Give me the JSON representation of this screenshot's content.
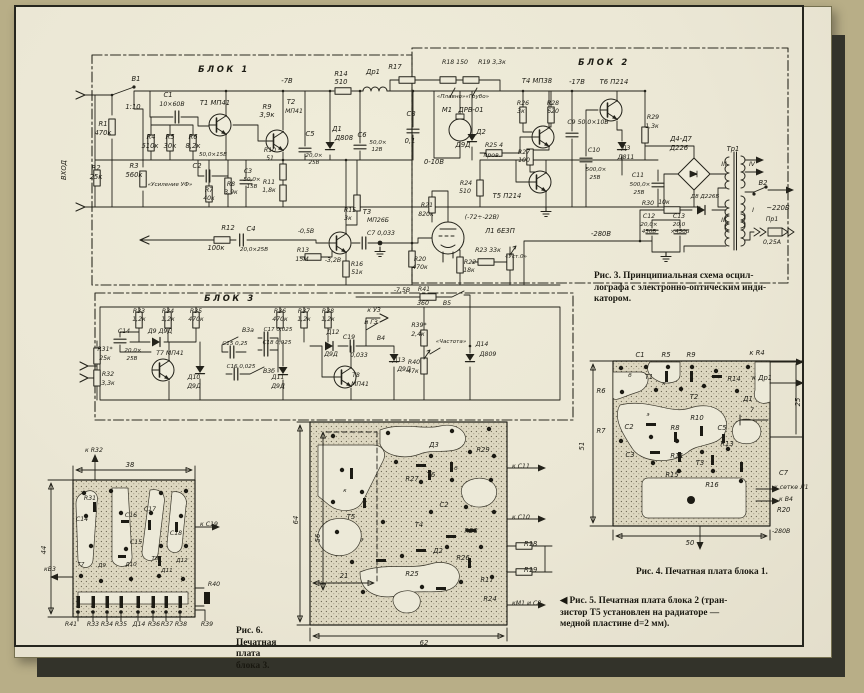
{
  "captions": {
    "fig3": [
      "Рис. 3. Принципиальная схема осцил-",
      "лографа с электронно-оптическим инди-",
      "катором."
    ],
    "fig4": [
      "Рис. 4. Печатная плата блока 1."
    ],
    "fig5": [
      "◀ Рис. 5. Печатная плата блока 2 (тран-",
      "зистор Т5 установлен на радиаторе —",
      "медной пластине d=2 мм)."
    ],
    "fig6": [
      "Рис. 6.",
      "Печатная",
      "плата",
      "блока 3."
    ]
  },
  "labels": {
    "schematic": [
      [
        "БЛОК 1",
        224,
        72,
        "b"
      ],
      [
        "БЛОК 2",
        604,
        65,
        "b"
      ],
      [
        "БЛОК 3",
        230,
        301,
        "b"
      ],
      [
        "ВХОД",
        66,
        170,
        "r"
      ],
      [
        "В1",
        136,
        81
      ],
      [
        "1:10",
        133,
        109
      ],
      [
        "C1",
        168,
        97
      ],
      [
        "10×60В",
        172,
        106,
        "m"
      ],
      [
        "R1",
        103,
        126
      ],
      [
        "470к",
        103,
        135
      ],
      [
        "R2",
        96,
        170
      ],
      [
        "25к",
        96,
        179
      ],
      [
        "R3",
        134,
        168
      ],
      [
        "560к",
        134,
        177
      ],
      [
        "«Усиление УФ»",
        170,
        186,
        "s"
      ],
      [
        "R4",
        151,
        139
      ],
      [
        "510к",
        150,
        148
      ],
      [
        "R5",
        170,
        139
      ],
      [
        "30к",
        170,
        148
      ],
      [
        "R6",
        193,
        139
      ],
      [
        "8,2к",
        193,
        148
      ],
      [
        "Т1 МП41",
        215,
        105
      ],
      [
        "C2",
        197,
        168
      ],
      [
        "50,0×15В",
        213,
        156,
        "s"
      ],
      [
        "R7",
        209,
        192,
        "m"
      ],
      [
        "40к",
        209,
        200,
        "m"
      ],
      [
        "R8",
        231,
        186,
        "m"
      ],
      [
        "3,9к",
        231,
        194,
        "m"
      ],
      [
        "C3",
        248,
        173,
        "m"
      ],
      [
        "50,0×",
        252,
        181,
        "s"
      ],
      [
        "15В",
        252,
        188,
        "s"
      ],
      [
        "-7В",
        287,
        83
      ],
      [
        "R9",
        267,
        109
      ],
      [
        "3,9к",
        267,
        117
      ],
      [
        "Т2",
        291,
        104
      ],
      [
        "МП41",
        294,
        113,
        "m"
      ],
      [
        "C5",
        310,
        136
      ],
      [
        "20,0×",
        314,
        157,
        "s"
      ],
      [
        "25В",
        314,
        164,
        "s"
      ],
      [
        "R10",
        270,
        152,
        "m"
      ],
      [
        "51",
        270,
        160,
        "m"
      ],
      [
        "R11",
        269,
        184,
        "m"
      ],
      [
        "1,8к",
        269,
        192,
        "m"
      ],
      [
        "R14",
        341,
        76
      ],
      [
        "510",
        341,
        84
      ],
      [
        "Др1",
        373,
        74
      ],
      [
        "Д1",
        337,
        131
      ],
      [
        "Д808",
        344,
        140
      ],
      [
        "C6",
        362,
        137
      ],
      [
        "50,0×",
        378,
        144,
        "s"
      ],
      [
        "12В",
        377,
        151,
        "s"
      ],
      [
        "C8",
        411,
        116
      ],
      [
        "0,1",
        410,
        143
      ],
      [
        "R17",
        395,
        69
      ],
      [
        "R18 150",
        455,
        64,
        "m"
      ],
      [
        "R19 3,3к",
        492,
        64,
        "m"
      ],
      [
        "«Плавно»«Грубо»",
        463,
        98,
        "s"
      ],
      [
        "Т4 МП38",
        537,
        83
      ],
      [
        "-17В",
        577,
        84
      ],
      [
        "М1",
        447,
        112
      ],
      [
        "ДРВ-01",
        471,
        112
      ],
      [
        "Д2",
        481,
        134
      ],
      [
        "Д9Д",
        463,
        147
      ],
      [
        "0-10В",
        434,
        164
      ],
      [
        "R26",
        523,
        105,
        "m"
      ],
      [
        "3к",
        521,
        113,
        "m"
      ],
      [
        "R28",
        553,
        105,
        "m"
      ],
      [
        "620",
        553,
        113,
        "m"
      ],
      [
        "R27",
        524,
        154,
        "m"
      ],
      [
        "100",
        524,
        162,
        "m"
      ],
      [
        "R25 4",
        494,
        147,
        "m"
      ],
      [
        "пров.",
        492,
        157,
        "m"
      ],
      [
        "R24",
        466,
        185,
        "m"
      ],
      [
        "510",
        465,
        193,
        "m"
      ],
      [
        "Т5 П214",
        507,
        198
      ],
      [
        "C9 50,0×10В",
        588,
        124,
        "m"
      ],
      [
        "Т6 П214",
        614,
        84
      ],
      [
        "C10",
        594,
        152,
        "m"
      ],
      [
        "500,0×",
        596,
        171,
        "s"
      ],
      [
        "25В",
        595,
        179,
        "s"
      ],
      [
        "Д3",
        626,
        150,
        "m"
      ],
      [
        "Д811",
        626,
        159,
        "m"
      ],
      [
        "R29",
        653,
        119,
        "m"
      ],
      [
        "1,3к",
        652,
        128,
        "m"
      ],
      [
        "C11",
        638,
        177,
        "m"
      ],
      [
        "500,0×",
        640,
        186,
        "s"
      ],
      [
        "25В",
        639,
        194,
        "s"
      ],
      [
        "Д4-Д7",
        681,
        141
      ],
      [
        "Д226",
        679,
        150
      ],
      [
        "Тр1",
        733,
        151
      ],
      [
        "R30",
        648,
        205,
        "m"
      ],
      [
        "10к",
        664,
        204,
        "m"
      ],
      [
        "Д8 Д226Б",
        705,
        198,
        "s"
      ],
      [
        "C12",
        649,
        218,
        "m"
      ],
      [
        "20,0×",
        649,
        226,
        "s"
      ],
      [
        "450В",
        649,
        233,
        "s"
      ],
      [
        "C13",
        679,
        218,
        "m"
      ],
      [
        "20,0",
        679,
        226,
        "s"
      ],
      [
        "×450В",
        680,
        233,
        "s"
      ],
      [
        "-280В",
        601,
        236
      ],
      [
        "III",
        724,
        166,
        "m"
      ],
      [
        "IV",
        752,
        166,
        "m"
      ],
      [
        "II",
        723,
        222,
        "m"
      ],
      [
        "I",
        753,
        212,
        "m"
      ],
      [
        "В2",
        763,
        185
      ],
      [
        "~220В",
        778,
        210
      ],
      [
        "Пр1",
        772,
        221,
        "m"
      ],
      [
        "0,25А",
        772,
        244,
        "m"
      ],
      [
        "R12",
        228,
        230
      ],
      [
        "100к",
        216,
        250
      ],
      [
        "C4",
        251,
        231
      ],
      [
        "20,0×25В",
        254,
        251,
        "s"
      ],
      [
        "Т3",
        367,
        214
      ],
      [
        "МП26Б",
        378,
        222,
        "m"
      ],
      [
        "R15",
        350,
        212,
        "m"
      ],
      [
        "3к",
        348,
        220,
        "m"
      ],
      [
        "-0,5В",
        306,
        233,
        "m"
      ],
      [
        "R13",
        303,
        252,
        "m"
      ],
      [
        "15М",
        302,
        261,
        "m"
      ],
      [
        "-3,2В",
        333,
        262,
        "m"
      ],
      [
        "R16",
        357,
        266,
        "m"
      ],
      [
        "51к",
        357,
        274,
        "m"
      ],
      [
        "C7 0,033",
        381,
        235,
        "m"
      ],
      [
        "R20",
        420,
        261,
        "m"
      ],
      [
        "470к",
        420,
        269,
        "m"
      ],
      [
        "R21",
        427,
        207,
        "m"
      ],
      [
        "820к",
        426,
        216,
        "m"
      ],
      [
        "(-72÷-22В)",
        482,
        219,
        "m"
      ],
      [
        "Л1 6Е3П",
        500,
        233
      ],
      [
        "R23 33к",
        488,
        252,
        "m"
      ],
      [
        "«Уст.0»",
        516,
        258,
        "s"
      ],
      [
        "R22",
        470,
        264,
        "m"
      ],
      [
        "18к",
        469,
        272,
        "m"
      ],
      [
        "-7,5В",
        402,
        292,
        "m"
      ],
      [
        "R41",
        424,
        291,
        "m"
      ],
      [
        "360",
        423,
        305,
        "m"
      ],
      [
        "В5",
        447,
        305,
        "m"
      ],
      [
        "R33",
        139,
        313,
        "m"
      ],
      [
        "1,2к",
        139,
        321,
        "m"
      ],
      [
        "R34",
        168,
        313,
        "m"
      ],
      [
        "1,2к",
        168,
        321,
        "m"
      ],
      [
        "R35",
        196,
        313,
        "m"
      ],
      [
        "470к",
        196,
        321,
        "m"
      ],
      [
        "R36",
        280,
        313,
        "m"
      ],
      [
        "470к",
        280,
        321,
        "m"
      ],
      [
        "R37",
        304,
        313,
        "m"
      ],
      [
        "1,2к",
        304,
        321,
        "m"
      ],
      [
        "R38",
        328,
        313,
        "m"
      ],
      [
        "1,2к",
        328,
        321,
        "m"
      ],
      [
        "C14",
        124,
        333,
        "m"
      ],
      [
        "20,0×",
        133,
        352,
        "s"
      ],
      [
        "25В",
        132,
        360,
        "s"
      ],
      [
        "R31*",
        105,
        351,
        "m"
      ],
      [
        "25к",
        105,
        360,
        "m"
      ],
      [
        "R32",
        108,
        376,
        "m"
      ],
      [
        "3,3к",
        108,
        385,
        "m"
      ],
      [
        "Д9 Д9Д",
        160,
        333,
        "m"
      ],
      [
        "Т7 МП41",
        170,
        355,
        "m"
      ],
      [
        "В3а",
        248,
        332,
        "m"
      ],
      [
        "C15 0,25",
        235,
        345,
        "s"
      ],
      [
        "C17 0,025",
        278,
        331,
        "s"
      ],
      [
        "C18 0,025",
        277,
        344,
        "s"
      ],
      [
        "C16 0,025",
        241,
        368,
        "s"
      ],
      [
        "В3б",
        269,
        373,
        "m"
      ],
      [
        "Д10",
        194,
        379,
        "m"
      ],
      [
        "Д9Д",
        194,
        388,
        "m"
      ],
      [
        "Д11",
        278,
        379,
        "m"
      ],
      [
        "Д9Д",
        278,
        388,
        "m"
      ],
      [
        "Д12",
        333,
        334,
        "m"
      ],
      [
        "Д9Д",
        331,
        356,
        "m"
      ],
      [
        "C19",
        349,
        339,
        "m"
      ],
      [
        "0,033",
        359,
        357,
        "m"
      ],
      [
        "к УЗ",
        374,
        312,
        "m"
      ],
      [
        "и ГЗ",
        371,
        324,
        "m"
      ],
      [
        "В4",
        381,
        340,
        "m"
      ],
      [
        "Д13",
        399,
        362,
        "m"
      ],
      [
        "Д9Д",
        404,
        371,
        "m"
      ],
      [
        "Т8",
        356,
        377,
        "m"
      ],
      [
        "МП41",
        360,
        386,
        "m"
      ],
      [
        "R39*",
        419,
        327,
        "m"
      ],
      [
        "2,4к",
        418,
        336,
        "m"
      ],
      [
        "«Частота»",
        451,
        343,
        "s"
      ],
      [
        "R40",
        414,
        364,
        "m"
      ],
      [
        "47к",
        413,
        373,
        "m"
      ],
      [
        "Д14",
        482,
        346,
        "m"
      ],
      [
        "Д809",
        488,
        356,
        "m"
      ]
    ],
    "board1": [
      [
        "C1",
        640,
        357
      ],
      [
        "R5",
        666,
        357
      ],
      [
        "R9",
        691,
        357
      ],
      [
        "к R4",
        757,
        355
      ],
      [
        "Т1",
        649,
        379
      ],
      [
        "R14",
        734,
        381
      ],
      [
        "к Др1",
        762,
        380
      ],
      [
        "R6",
        601,
        393
      ],
      [
        "Т2",
        694,
        399
      ],
      [
        "Д1",
        748,
        401
      ],
      [
        "б",
        630,
        377,
        "s"
      ],
      [
        "к",
        664,
        385,
        "s"
      ],
      [
        "э",
        648,
        416,
        "s"
      ],
      [
        "C2",
        629,
        429
      ],
      [
        "R8",
        675,
        430
      ],
      [
        "R10",
        697,
        420
      ],
      [
        "C5",
        722,
        430
      ],
      [
        "R7",
        601,
        433
      ],
      [
        "C3",
        630,
        457
      ],
      [
        "R11",
        677,
        458
      ],
      [
        "R13",
        727,
        446
      ],
      [
        "Т3",
        700,
        465
      ],
      [
        "R15",
        672,
        477
      ],
      [
        "R16",
        712,
        487
      ],
      [
        "C7",
        779,
        475,
        "a"
      ],
      [
        "к сетке Л1",
        774,
        489,
        "am"
      ],
      [
        "к В4",
        779,
        501,
        "am"
      ],
      [
        "R20",
        777,
        512,
        "a"
      ],
      [
        "-280В",
        772,
        533,
        "am"
      ],
      [
        "51",
        584,
        446,
        "r"
      ],
      [
        "50",
        690,
        545
      ],
      [
        "25",
        800,
        402,
        "r"
      ],
      [
        "7",
        752,
        412,
        "m"
      ]
    ],
    "board2": [
      [
        "Д3",
        434,
        447
      ],
      [
        "R29",
        483,
        452
      ],
      [
        "к C11",
        512,
        468,
        "am"
      ],
      [
        "Т6",
        431,
        477
      ],
      [
        "R27",
        412,
        481
      ],
      [
        "б",
        456,
        470,
        "s"
      ],
      [
        "к",
        345,
        492,
        "s"
      ],
      [
        "Т5",
        351,
        519
      ],
      [
        "Т4",
        419,
        527
      ],
      [
        "э",
        362,
        541,
        "s"
      ],
      [
        "C2",
        444,
        507
      ],
      [
        "к C10",
        512,
        519,
        "am"
      ],
      [
        "R28",
        471,
        533
      ],
      [
        "R18",
        524,
        546,
        "a"
      ],
      [
        "Д2",
        438,
        553
      ],
      [
        "R26",
        463,
        560
      ],
      [
        "R19",
        524,
        572,
        "a"
      ],
      [
        "R25",
        412,
        576
      ],
      [
        "R17",
        487,
        582
      ],
      [
        "R24",
        490,
        601
      ],
      [
        "кМ1 и С8",
        512,
        605,
        "am"
      ],
      [
        "64",
        298,
        520,
        "r"
      ],
      [
        "56",
        320,
        538,
        "r"
      ],
      [
        "21",
        344,
        578
      ],
      [
        "62",
        424,
        645
      ]
    ],
    "board3": [
      [
        "к R32",
        94,
        452,
        "m"
      ],
      [
        "38",
        130,
        467
      ],
      [
        "44",
        46,
        550,
        "r"
      ],
      [
        "R31",
        90,
        500,
        "m"
      ],
      [
        "C14",
        82,
        521,
        "m"
      ],
      [
        "C16",
        131,
        517,
        "m"
      ],
      [
        "C17",
        150,
        511,
        "m"
      ],
      [
        "к C19",
        200,
        526,
        "am"
      ],
      [
        "C15",
        136,
        544,
        "m"
      ],
      [
        "C18",
        176,
        535,
        "m"
      ],
      [
        "кВ3",
        50,
        571,
        "m"
      ],
      [
        "Т7",
        81,
        566,
        "s"
      ],
      [
        "Д9",
        102,
        567,
        "s"
      ],
      [
        "Д10",
        131,
        566,
        "s"
      ],
      [
        "Т8",
        155,
        560,
        "s"
      ],
      [
        "Д11",
        167,
        572,
        "s"
      ],
      [
        "Д12",
        182,
        562,
        "s"
      ],
      [
        "R40",
        214,
        586,
        "m"
      ],
      [
        "R41",
        71,
        626,
        "m"
      ],
      [
        "R33",
        93,
        626,
        "m"
      ],
      [
        "R34",
        107,
        626,
        "m"
      ],
      [
        "R35",
        121,
        626,
        "m"
      ],
      [
        "Д14",
        139,
        626,
        "m"
      ],
      [
        "R36",
        154,
        626,
        "m"
      ],
      [
        "R37",
        167,
        626,
        "m"
      ],
      [
        "R38",
        181,
        626,
        "m"
      ],
      [
        "R39",
        207,
        626,
        "m"
      ]
    ]
  }
}
